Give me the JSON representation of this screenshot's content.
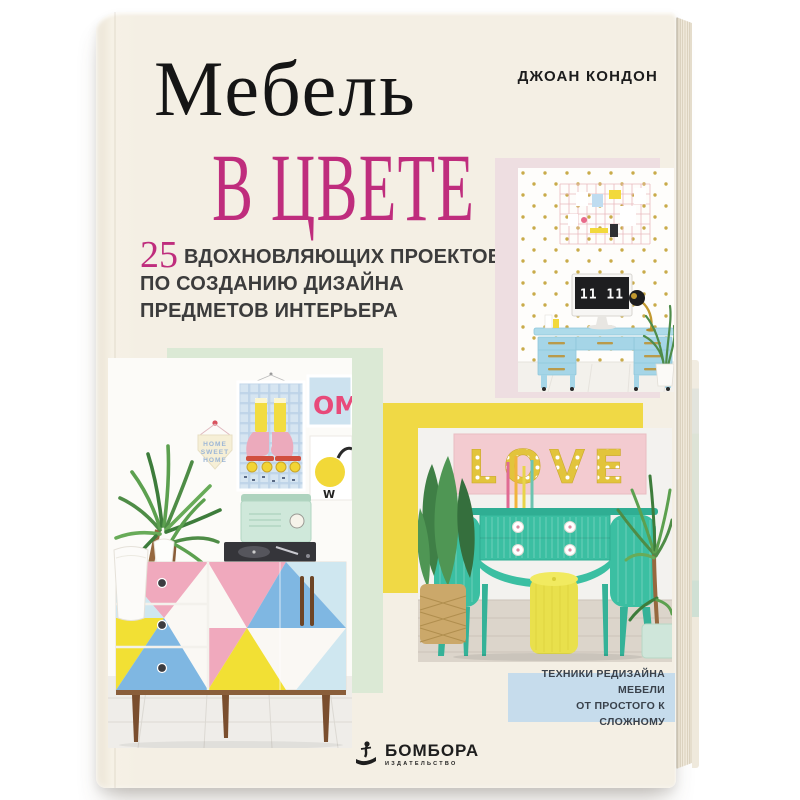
{
  "book": {
    "author": "ДЖОАН КОНДОН",
    "title": {
      "line1": "Мебель",
      "line2": "в цвете"
    },
    "subtitle": {
      "number": "25",
      "line1": "ВДОХНОВЛЯЮЩИХ ПРОЕКТОВ",
      "line2": "ПО СОЗДАНИЮ ДИЗАЙНА",
      "line3": "ПРЕДМЕТОВ ИНТЕРЬЕРА"
    },
    "badge": {
      "line1": "ТЕХНИКИ РЕДИЗАЙНА МЕБЕЛИ",
      "line2": "ОТ ПРОСТОГО К СЛОЖНОМУ"
    },
    "publisher": {
      "name": "БОМБОРА",
      "tagline": "ИЗДАТЕЛЬСТВО"
    },
    "photos": {
      "desk": {
        "clock": "11 11"
      },
      "gallery": {
        "pennant": [
          "HOME",
          "SWEET",
          "HOME"
        ],
        "poster": "OM"
      },
      "love": {
        "sign": "LOVE"
      }
    },
    "colors": {
      "cover_cream": "#f4efe4",
      "accent_magenta": "#bf2d7d",
      "pastel_pink_block": "#eedee1",
      "pastel_mint_block": "#dbe9d5",
      "accent_yellow_block": "#f0d945",
      "badge_blue": "#c6dcec",
      "furniture_teal": "#3bbfa2",
      "desk_blue": "#a5d5e7"
    }
  }
}
